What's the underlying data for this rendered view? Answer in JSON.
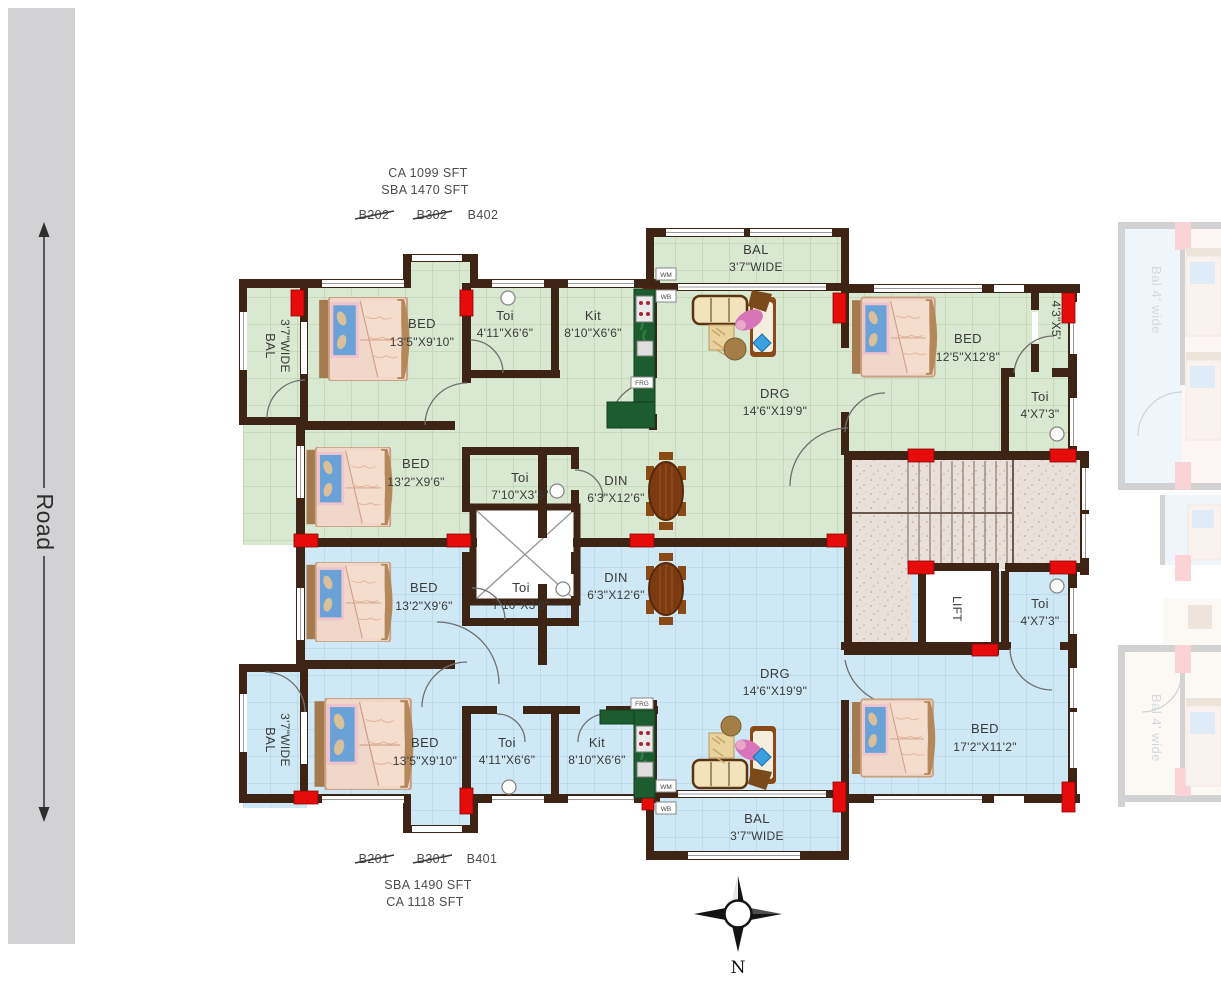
{
  "road": {
    "label": "Road"
  },
  "compass": {
    "north_label": "N"
  },
  "unit_green": {
    "area_line1": "CA 1099 SFT",
    "area_line2": "SBA 1470 SFT",
    "id_struck1": "B202",
    "id_struck2": "B302",
    "id_active": "B402",
    "rooms": [
      {
        "name": "BAL",
        "dim": "3'7\"WIDE"
      },
      {
        "name": "BED",
        "dim": "13'5\"X9'10\""
      },
      {
        "name": "Toi",
        "dim": "4'11\"X6'6\""
      },
      {
        "name": "Kit",
        "dim": "8'10\"X6'6\""
      },
      {
        "name": "BAL",
        "dim": "3'7\"WIDE"
      },
      {
        "name": "DRG",
        "dim": "14'6\"X19'9\""
      },
      {
        "name": "BED",
        "dim": "12'5\"X12'8\""
      },
      {
        "name": "",
        "dim": "4'3\"X5'"
      },
      {
        "name": "Toi",
        "dim": "4'X7'3\""
      },
      {
        "name": "BED",
        "dim": "13'2\"X9'6\""
      },
      {
        "name": "Toi",
        "dim": "7'10\"X3'8\""
      },
      {
        "name": "DIN",
        "dim": "6'3\"X12'6\""
      }
    ],
    "appliances": {
      "wm": "WM",
      "wb": "WB",
      "frg": "FRG"
    }
  },
  "unit_blue": {
    "area_line1": "SBA 1490 SFT",
    "area_line2": "CA 1118 SFT",
    "id_struck1": "B201",
    "id_struck2": "B301",
    "id_active": "B401",
    "rooms": [
      {
        "name": "BED",
        "dim": "13'2\"X9'6\""
      },
      {
        "name": "Toi",
        "dim": "7'10\"X3'8\""
      },
      {
        "name": "DIN",
        "dim": "6'3\"X12'6\""
      },
      {
        "name": "DRG",
        "dim": "14'6\"X19'9\""
      },
      {
        "name": "Toi",
        "dim": "4'X7'3\""
      },
      {
        "name": "BED",
        "dim": "17'2\"X11'2\""
      },
      {
        "name": "BED",
        "dim": "13'5\"X9'10\""
      },
      {
        "name": "Toi",
        "dim": "4'11\"X6'6\""
      },
      {
        "name": "Kit",
        "dim": "8'10\"X6'6\""
      },
      {
        "name": "BAL",
        "dim": "3'7\"WIDE"
      },
      {
        "name": "BAL",
        "dim": "3'7\"WIDE"
      }
    ],
    "appliances": {
      "wm": "WM",
      "wb": "WB",
      "frg": "FRG"
    }
  },
  "core": {
    "lift_label": "LIFT"
  },
  "side_plans": {
    "bal_label_top": "Bal 4' wide",
    "bal_label_bottom": "Bal 4' wide"
  },
  "colors": {
    "green_unit": "#d9e8d0",
    "blue_unit": "#cfe8f6",
    "wall": "#3e2415",
    "column_marker": "#e60c0c",
    "road": "#d2d2d4"
  }
}
